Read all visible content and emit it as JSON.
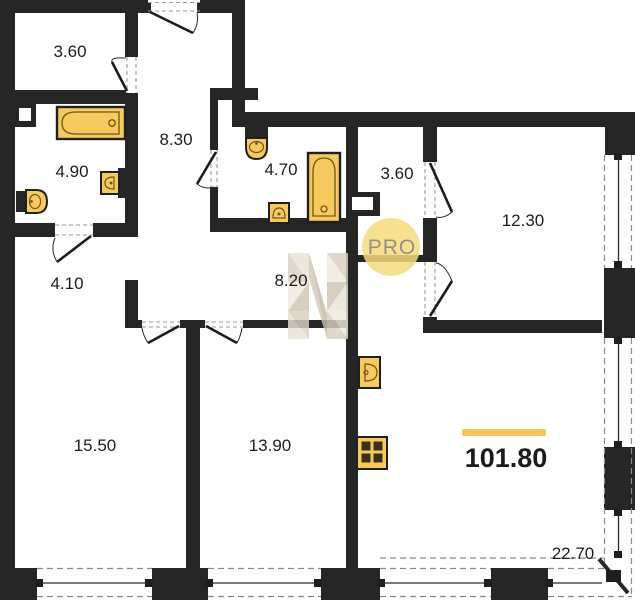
{
  "plan": {
    "watermark": {
      "label": "PRO"
    },
    "total_area": "101.80",
    "rooms": [
      {
        "name": "storage-1",
        "area": "3.60"
      },
      {
        "name": "bathroom-1",
        "area": "4.90"
      },
      {
        "name": "hallway-1",
        "area": "8.30"
      },
      {
        "name": "bathroom-2",
        "area": "4.70"
      },
      {
        "name": "wardrobe",
        "area": "3.60"
      },
      {
        "name": "bedroom-1",
        "area": "12.30"
      },
      {
        "name": "corridor",
        "area": "4.10"
      },
      {
        "name": "hallway-2",
        "area": "8.20"
      },
      {
        "name": "bedroom-2",
        "area": "15.50"
      },
      {
        "name": "bedroom-3",
        "area": "13.90"
      },
      {
        "name": "terrace",
        "area": "22.70"
      }
    ],
    "colors": {
      "wall": "#262626",
      "fixture": "#F7CA5F",
      "fixture_detail": "#6b5718",
      "highlight_bar": "#F2C658",
      "watermark_circle": "#F6DC7E"
    }
  }
}
